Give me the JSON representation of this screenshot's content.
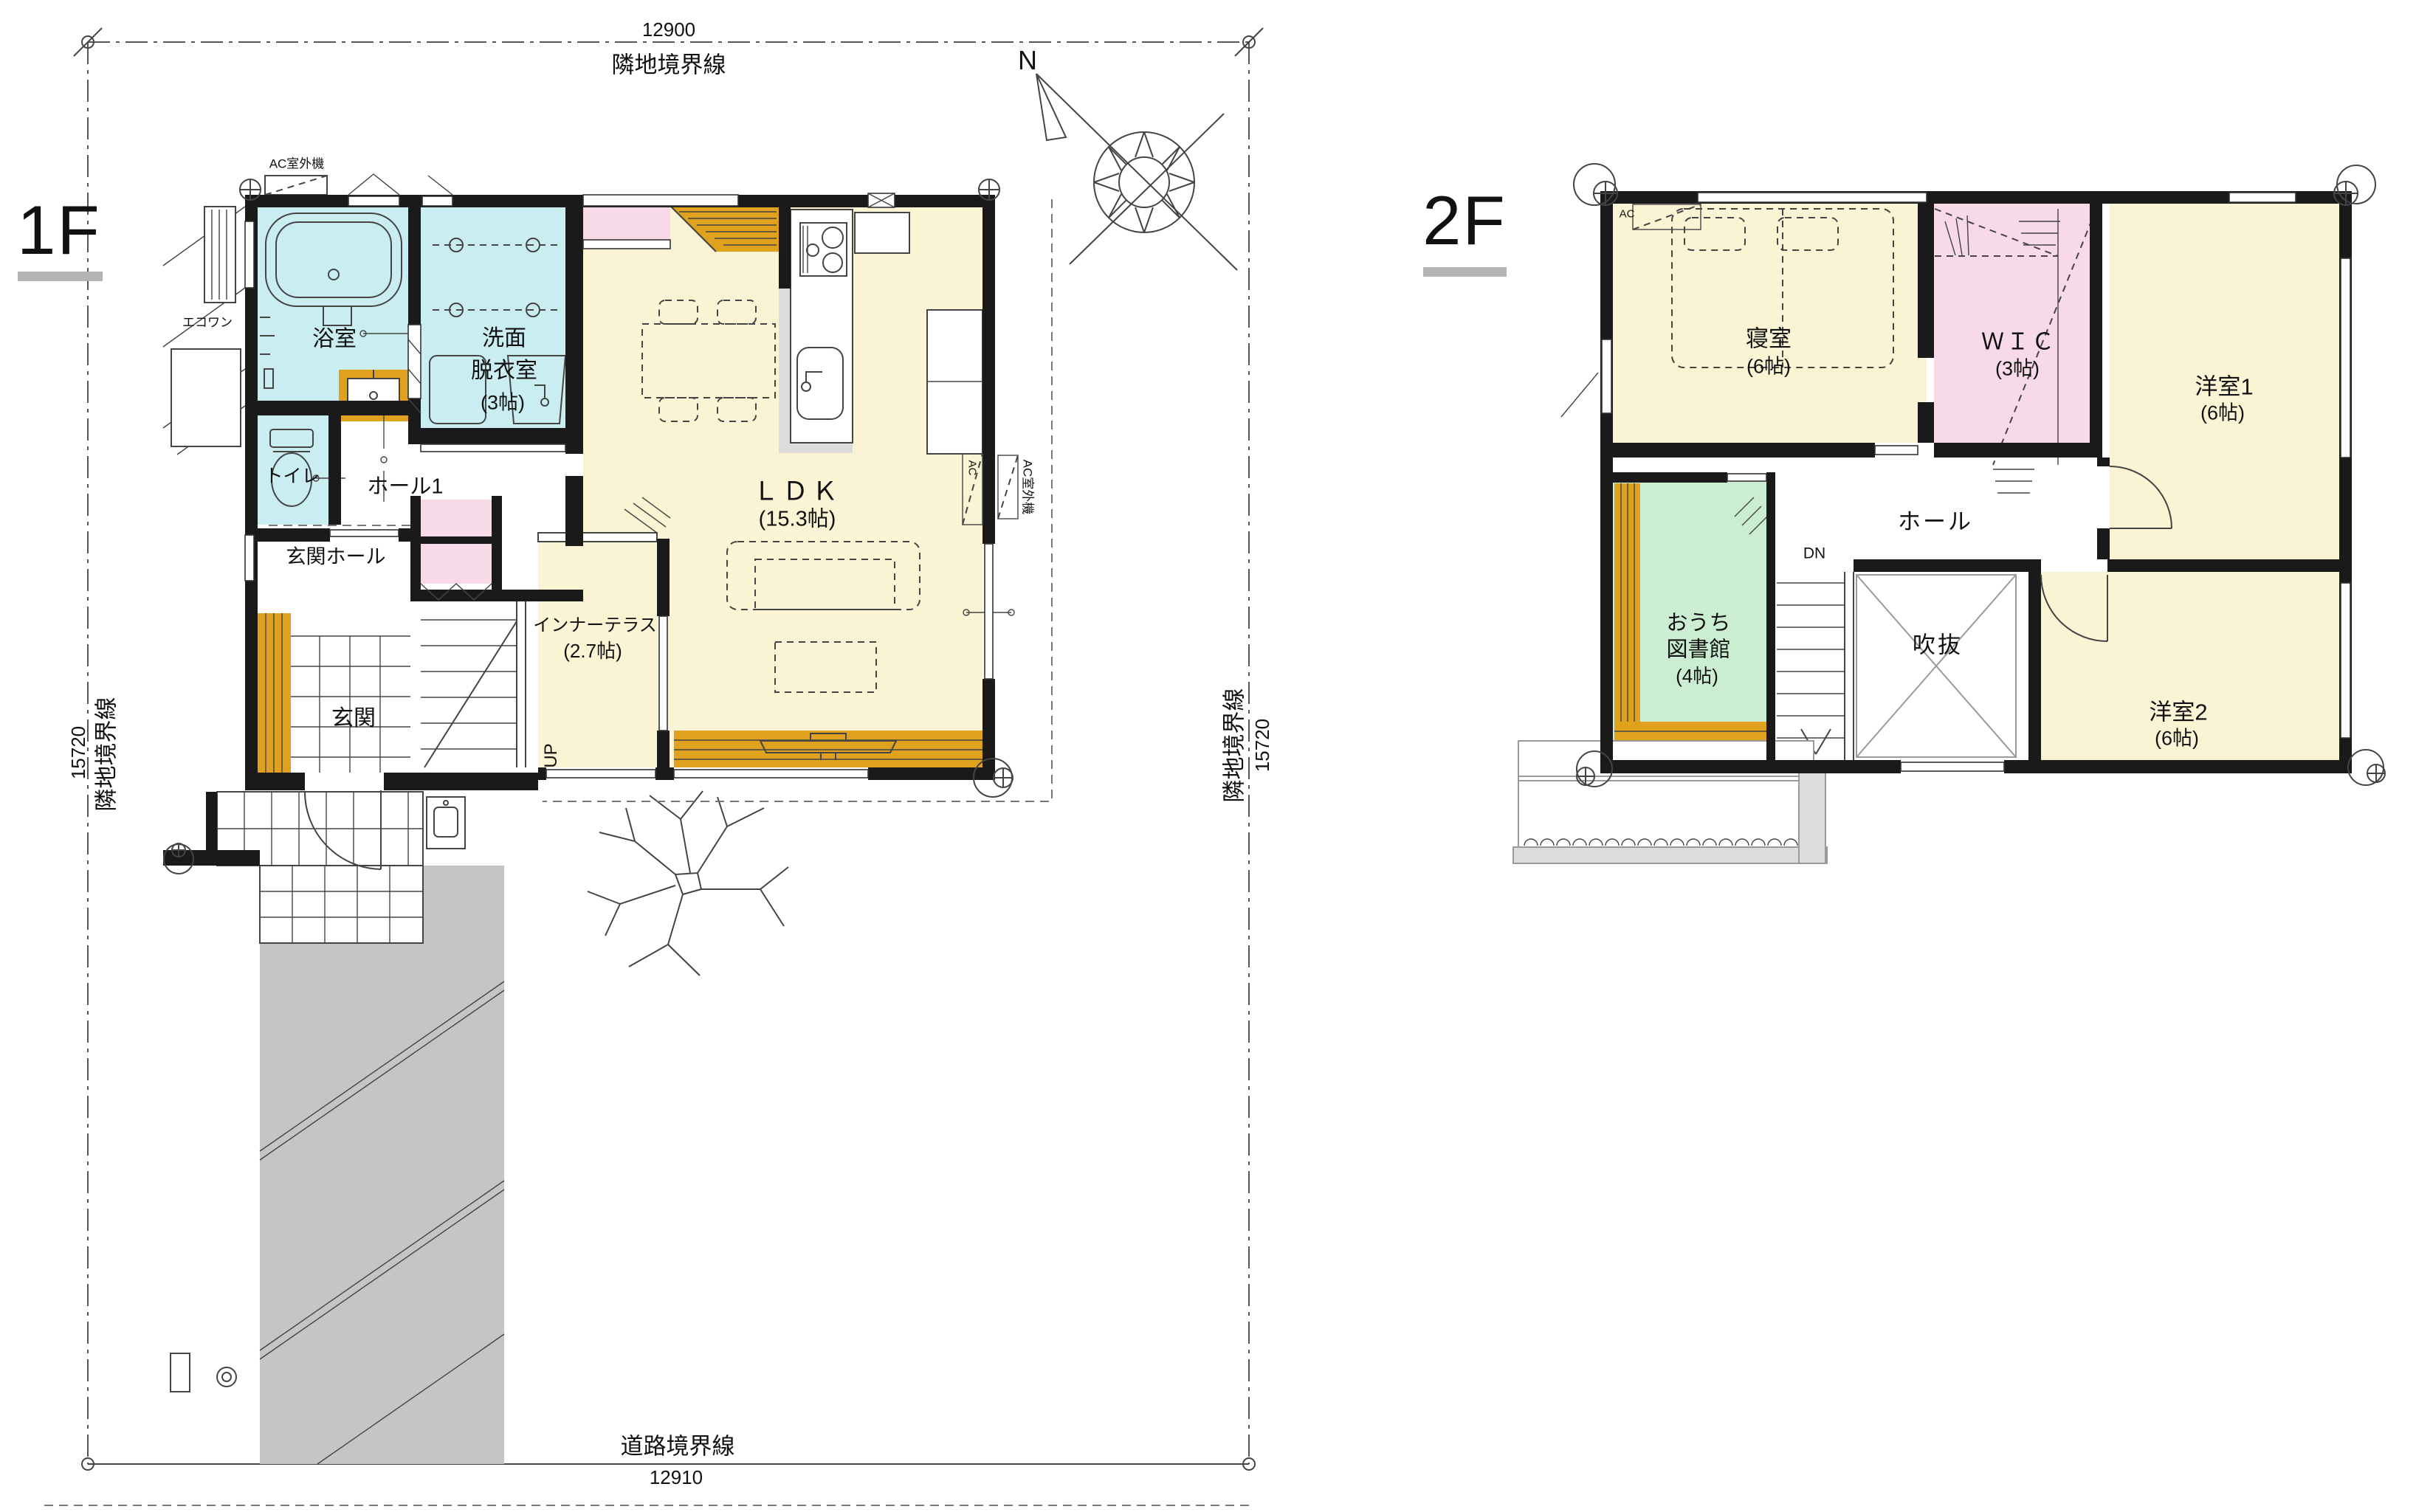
{
  "floor1": {
    "title": "1F",
    "boundary": {
      "top_dim": "12900",
      "top_label": "隣地境界線",
      "left_dim": "15720",
      "left_label": "隣地境界線",
      "right_label": "隣地境界線",
      "right_dim": "15720",
      "bottom_label": "道路境界線",
      "bottom_dim": "12910"
    },
    "compass": "N",
    "rooms": {
      "bath": "浴室",
      "washroom_line1": "洗面",
      "washroom_line2": "脱衣室",
      "washroom_size": "(3帖)",
      "toilet": "トイレ",
      "hall1": "ホール1",
      "entrance_hall": "玄関ホール",
      "entrance": "玄関",
      "inner_terrace": "インナーテラス",
      "inner_terrace_size": "(2.7帖)",
      "ldk": "ＬＤＫ",
      "ldk_size": "(15.3帖)",
      "up": "UP"
    },
    "equipment": {
      "ac_outdoor_top": "AC室外機",
      "ac_outdoor_right": "AC室外機",
      "ac_wall": "AC",
      "ecoone": "エコワン"
    }
  },
  "floor2": {
    "title": "2F",
    "rooms": {
      "bedroom": "寝室",
      "bedroom_size": "(6帖)",
      "wic": "ＷＩＣ",
      "wic_size": "(3帖)",
      "western1": "洋室1",
      "western1_size": "(6帖)",
      "hall": "ホール",
      "dn": "DN",
      "library_line1": "おうち",
      "library_line2": "図書館",
      "library_size": "(4帖)",
      "void": "吹抜",
      "western2": "洋室2",
      "western2_size": "(6帖)",
      "ac": "AC"
    }
  },
  "colors": {
    "wall": "#1a1a1a",
    "room-yellow": "#FAF4D4",
    "room-cyan": "#C9EDF1",
    "room-pink": "#F7D9E7",
    "room-green": "#CBEDD1",
    "wood-orange": "#DFA11E",
    "driveway-gray": "#C5C5C5",
    "underline-gray": "#B3B3B3"
  }
}
